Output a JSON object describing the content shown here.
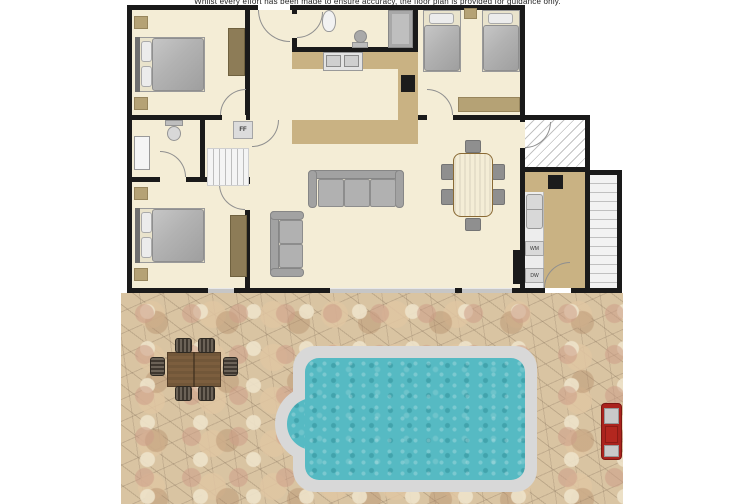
{
  "disclaimer": "Whilst every effort has been made to ensure accuracy, the floor plan is provided for guidance only.",
  "appliance_labels": {
    "fridge_freezer": "FF",
    "washing_machine": "WM",
    "dishwasher": "DW"
  },
  "colors": {
    "wall": "#1a1a1a",
    "floor": "#f4edd6",
    "counter": "#c9b283",
    "wardrobe": "#8d7c57",
    "furniture_tan": "#b5a275",
    "sofa_gray": "#b1b1b1",
    "chair_gray": "#8f8f8f",
    "dining_wood": "#a8813f",
    "pool_water": "#56bac3",
    "pool_surround": "#d8d8d8",
    "patio_base": "#d9c4a2",
    "outdoor_table": "#7c5e3e",
    "bbq_red": "#aa231d"
  }
}
